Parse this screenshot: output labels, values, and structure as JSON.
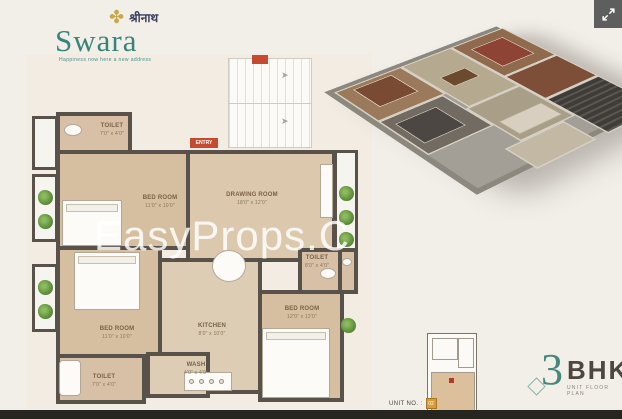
{
  "logo": {
    "brand": "Swara",
    "devanagari": "श्रीनाथ",
    "tagline": "Happiness now here a new address"
  },
  "watermark": {
    "text": "EasyProps.C"
  },
  "plan": {
    "entry": "ENTRY",
    "rooms": {
      "toilet_top": {
        "name": "TOILET",
        "dims": "7'0\" x 4'0\""
      },
      "bedroom_top": {
        "name": "BED ROOM",
        "dims": "11'0\" x 10'0\""
      },
      "drawing": {
        "name": "DRAWING ROOM",
        "dims": "18'0\" x 12'0\""
      },
      "toilet_mid": {
        "name": "TOILET",
        "dims": "8'0\" x 4'0\""
      },
      "bedroom_left": {
        "name": "BED ROOM",
        "dims": "11'0\" x 10'0\""
      },
      "kitchen": {
        "name": "KITCHEN",
        "dims": "8'0\" x 10'0\""
      },
      "wash": {
        "name": "WASH",
        "dims": "4'0\" x 4'0\""
      },
      "toilet_bottom": {
        "name": "TOILET",
        "dims": "7'0\" x 4'0\""
      },
      "bedroom_right": {
        "name": "BED ROOM",
        "dims": "12'0\" x 12'0\""
      }
    }
  },
  "footer": {
    "unit_label": "UNIT NO. :",
    "unit_value": "02",
    "bhk_number": "3",
    "bhk_text": "BHK",
    "bhk_subtitle": "UNIT FLOOR PLAN"
  },
  "colors": {
    "brand_teal": "#37857a",
    "accent_gold": "#c9a84c",
    "floor_tan": "#d6bfa0",
    "wall": "#59524b",
    "entry_red": "#c64a2e",
    "plant_green": "#5f8f3d"
  }
}
